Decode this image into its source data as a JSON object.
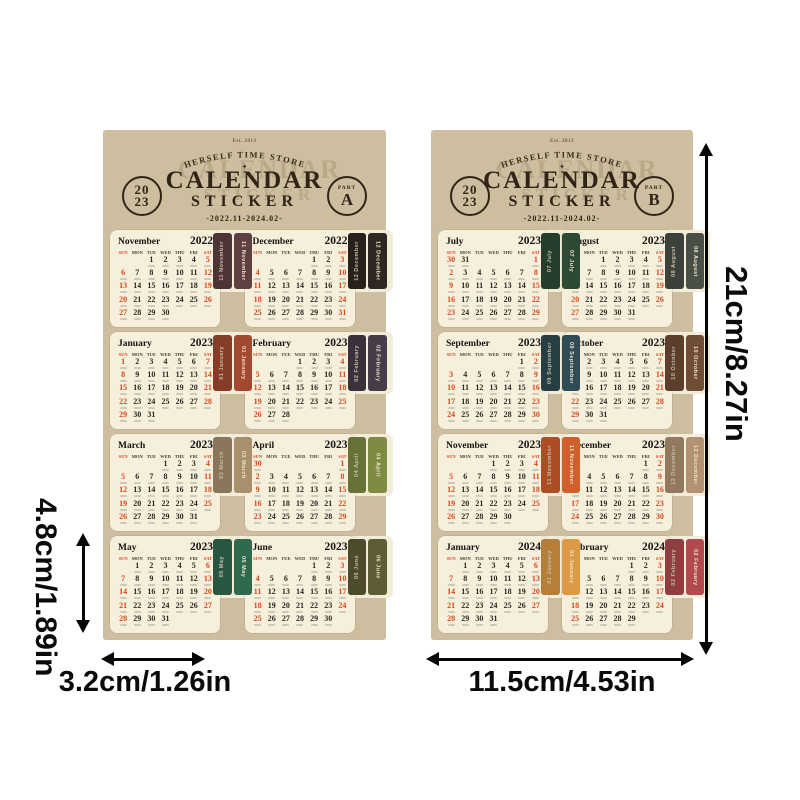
{
  "brand": {
    "est": "Est. 2013",
    "arc": "HERSELF TIME STORE",
    "ornament": "✦",
    "title": "CALENDAR",
    "subtitle": "STICKER",
    "range": "-2022.11-2024.02-",
    "year_top": "20",
    "year_bottom": "23",
    "part_word": "PART"
  },
  "calendar": {
    "weekdays": [
      "SUN",
      "MON",
      "TUE",
      "WED",
      "THU",
      "FRI",
      "SAT"
    ],
    "weekend_color": "#d9481c",
    "sheet_color": "#ccbe9e",
    "card_color": "#f5efdc"
  },
  "sheets": [
    {
      "part_letter": "A",
      "months": [
        {
          "name": "November",
          "year": "2022",
          "tab": "11 November",
          "color": "#5f4040",
          "first_day": 2,
          "days": 30
        },
        {
          "name": "December",
          "year": "2022",
          "tab": "12 December",
          "color": "#2f2721",
          "first_day": 4,
          "days": 31
        },
        {
          "name": "January",
          "year": "2023",
          "tab": "01 January",
          "color": "#a3492f",
          "first_day": 0,
          "days": 31
        },
        {
          "name": "February",
          "year": "2023",
          "tab": "02 February",
          "color": "#473c4a",
          "first_day": 3,
          "days": 28
        },
        {
          "name": "March",
          "year": "2023",
          "tab": "03 March",
          "color": "#a8906c",
          "first_day": 3,
          "days": 31
        },
        {
          "name": "April",
          "year": "2023",
          "tab": "04 April",
          "color": "#7e8c42",
          "first_day": 6,
          "days": 30
        },
        {
          "name": "May",
          "year": "2023",
          "tab": "05 May",
          "color": "#2f6a4f",
          "first_day": 1,
          "days": 31
        },
        {
          "name": "June",
          "year": "2023",
          "tab": "06 June",
          "color": "#5d5c35",
          "first_day": 4,
          "days": 30
        }
      ]
    },
    {
      "part_letter": "B",
      "months": [
        {
          "name": "July",
          "year": "2023",
          "tab": "07 July",
          "color": "#2e4a34",
          "first_day": 6,
          "days": 31
        },
        {
          "name": "August",
          "year": "2023",
          "tab": "08 August",
          "color": "#494f45",
          "first_day": 2,
          "days": 31
        },
        {
          "name": "September",
          "year": "2023",
          "tab": "09 September",
          "color": "#2f4b54",
          "first_day": 5,
          "days": 30
        },
        {
          "name": "October",
          "year": "2023",
          "tab": "10 October",
          "color": "#6f4c34",
          "first_day": 0,
          "days": 31
        },
        {
          "name": "November",
          "year": "2023",
          "tab": "11 November",
          "color": "#d05f2c",
          "first_day": 3,
          "days": 30
        },
        {
          "name": "December",
          "year": "2023",
          "tab": "12 December",
          "color": "#b29272",
          "first_day": 5,
          "days": 31
        },
        {
          "name": "January",
          "year": "2024",
          "tab": "01 January",
          "color": "#dd9a45",
          "first_day": 1,
          "days": 31
        },
        {
          "name": "February",
          "year": "2024",
          "tab": "02 February",
          "color": "#b04a50",
          "first_day": 4,
          "days": 29
        }
      ]
    }
  ],
  "dimensions": {
    "height": "21cm/8.27in",
    "card_height": "4.8cm/1.89in",
    "card_width": "3.2cm/1.26in",
    "sheet_width": "11.5cm/4.53in"
  }
}
